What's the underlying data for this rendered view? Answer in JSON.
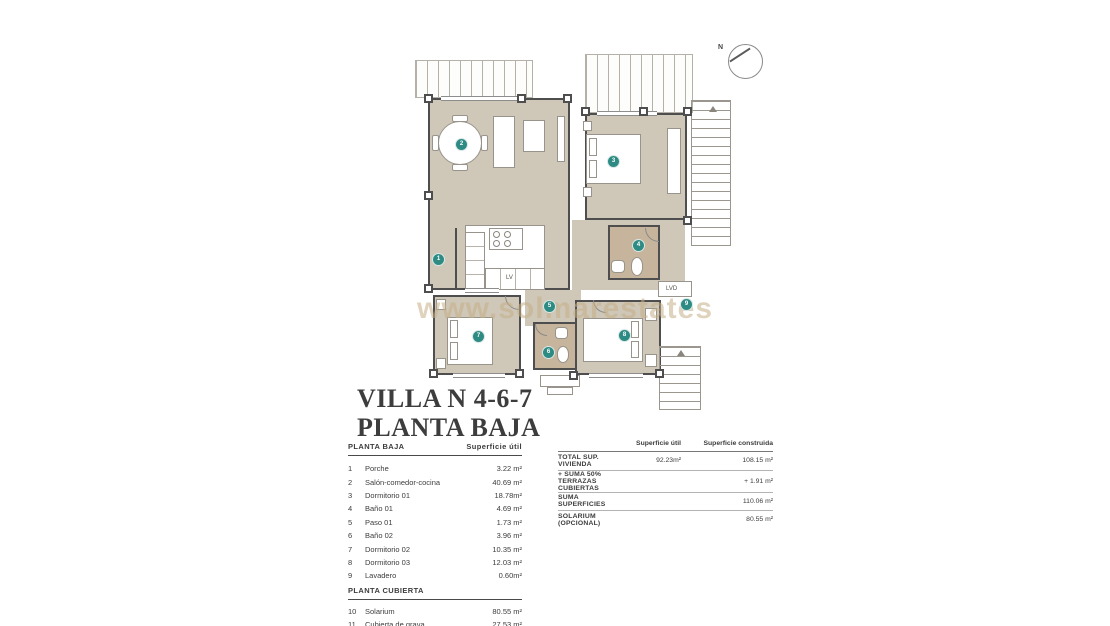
{
  "title": {
    "line1": "VILLA N 4-6-7",
    "line2": "PLANTA BAJA"
  },
  "compass": {
    "label": "N"
  },
  "watermark": "www.solmarestates.com",
  "plan": {
    "labels": {
      "lv": "LV",
      "lvd": "LVD"
    },
    "markers": [
      {
        "n": "1"
      },
      {
        "n": "2"
      },
      {
        "n": "3"
      },
      {
        "n": "4"
      },
      {
        "n": "5"
      },
      {
        "n": "6"
      },
      {
        "n": "7"
      },
      {
        "n": "8"
      },
      {
        "n": "9"
      }
    ]
  },
  "surface_table": {
    "header": "PLANTA BAJA",
    "col_util": "Superficie útil",
    "rows": [
      {
        "num": "1",
        "name": "Porche",
        "value": "3.22 m²"
      },
      {
        "num": "2",
        "name": "Salón-comedor-cocina",
        "value": "40.69 m²"
      },
      {
        "num": "3",
        "name": "Dormitorio 01",
        "value": "18.78m²"
      },
      {
        "num": "4",
        "name": "Baño 01",
        "value": "4.69 m²"
      },
      {
        "num": "5",
        "name": "Paso 01",
        "value": "1.73 m²"
      },
      {
        "num": "6",
        "name": "Baño 02",
        "value": "3.96 m²"
      },
      {
        "num": "7",
        "name": "Dormitorio 02",
        "value": "10.35 m²"
      },
      {
        "num": "8",
        "name": "Dormitorio 03",
        "value": "12.03 m²"
      },
      {
        "num": "9",
        "name": "Lavadero",
        "value": "0.60m²"
      }
    ],
    "header2": "PLANTA CUBIERTA",
    "rows2": [
      {
        "num": "10",
        "name": "Solarium",
        "value": "80.55 m²"
      },
      {
        "num": "11",
        "name": "Cubierta de grava",
        "value": "27.53 m²"
      }
    ]
  },
  "totals_table": {
    "col_util": "Superficie útil",
    "col_construida": "Superficie construida",
    "rows": [
      {
        "label": "TOTAL SUP. VIVIENDA",
        "util": "92.23m²",
        "construida": "108.15 m²"
      },
      {
        "label": "+ SUMA 50% TERRAZAS CUBIERTAS",
        "util": "",
        "construida": "+ 1.91 m²"
      },
      {
        "label": "SUMA SUPERFICIES",
        "util": "",
        "construida": "110.06 m²"
      },
      {
        "label": "SOLARIUM (OPCIONAL)",
        "util": "",
        "construida": "80.55 m²"
      }
    ]
  },
  "colors": {
    "floor": "#cfc7b8",
    "bath_floor": "#c6b49c",
    "wall": "#4e4e4e",
    "marker": "#2e8b84",
    "watermark": "#c6ae86"
  }
}
